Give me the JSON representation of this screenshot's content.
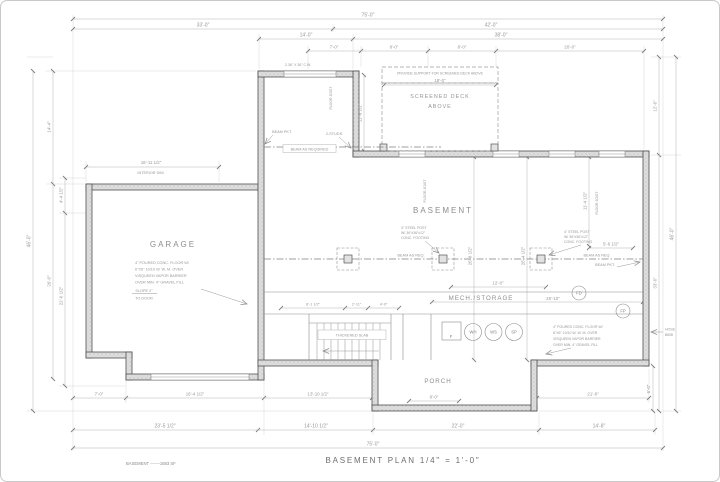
{
  "title": "BASEMENT PLAN   1/4\" = 1'-0\"",
  "legend": "BASEMENT -------1683 SF",
  "rooms": {
    "garage": "GARAGE",
    "basement": "BASEMENT",
    "mech_storage": "MECH./STORAGE",
    "porch": "PORCH",
    "screened_deck_1": "SCREENED DECK",
    "screened_deck_2": "ABOVE"
  },
  "notes": {
    "deck_support": "PROVIDE SUPPORT FOR SCREENED DECK ABOVE",
    "conc_floor": [
      "4\" POURED CONC. FLOOR W/",
      "6\"X6\" 10/10 W. W. M. OVER",
      "VISQUEEN VAPOR BARRIER",
      "OVER MIN. 4\" GRAVEL FILL"
    ],
    "steel_post": [
      "4\" STEEL POST",
      "W/ 36\"x36\"x12\"",
      "CONC. FOOTING"
    ],
    "beam_pkt": "BEAM PKT.",
    "beam_as_required": "BEAM AS REQUIRED",
    "beam_as_req": "BEAM AS REQ.",
    "slope": [
      "SLOPE 2\"",
      "TO DOOR"
    ],
    "thickened_slab": "THICKENED SLAB",
    "floor_joist": "FLOOR JOIST",
    "hose_bibb": [
      "HOSE",
      "BIBB"
    ],
    "window_callout": "2-36\" X 36\" C.W.",
    "studs": "2-STUDS"
  },
  "equipment": {
    "wh": "WH",
    "ws": "WS",
    "sp": "SP",
    "fd": "FD",
    "fp": "FP",
    "furnace": "F"
  },
  "dims": {
    "top": [
      "75'-0\"",
      "33'-0\"",
      "42'-0\"",
      "14'-0\"",
      "38'-0\"",
      "7'-0\"",
      "8'-0\"",
      "8'-0\"",
      "20'-0\"",
      "18'-0\""
    ],
    "bottom": [
      "7'-0\"",
      "16'-4 1/2\"",
      "13'-10 1/2\"",
      "8'-0\"",
      "21'-8\"",
      "23'-5 1/2\"",
      "14'-10 1/2\"",
      "22'-0\"",
      "14'-8\"",
      "75'-0\"",
      "6'-0\""
    ],
    "left": [
      "46'-0\"",
      "14'-4\"",
      "26'-0\"",
      "4'-4 1/2\"",
      "22'-0 1/2\"",
      "16'-11 1/2\"",
      "INTERIOR DIM."
    ],
    "right": [
      "12'-6\"",
      "33'-6\"",
      "46'-0\""
    ],
    "interior": [
      "11'-6 1/2\"",
      "26'-8 1/2\"",
      "26'-4 1/2\"",
      "11'-4 1/2\"",
      "5'-6 1/2\"",
      "12'-0\"",
      "26'-10\"",
      "8'-1 1/2\"",
      "2'-11\"",
      "4'-0\""
    ]
  }
}
